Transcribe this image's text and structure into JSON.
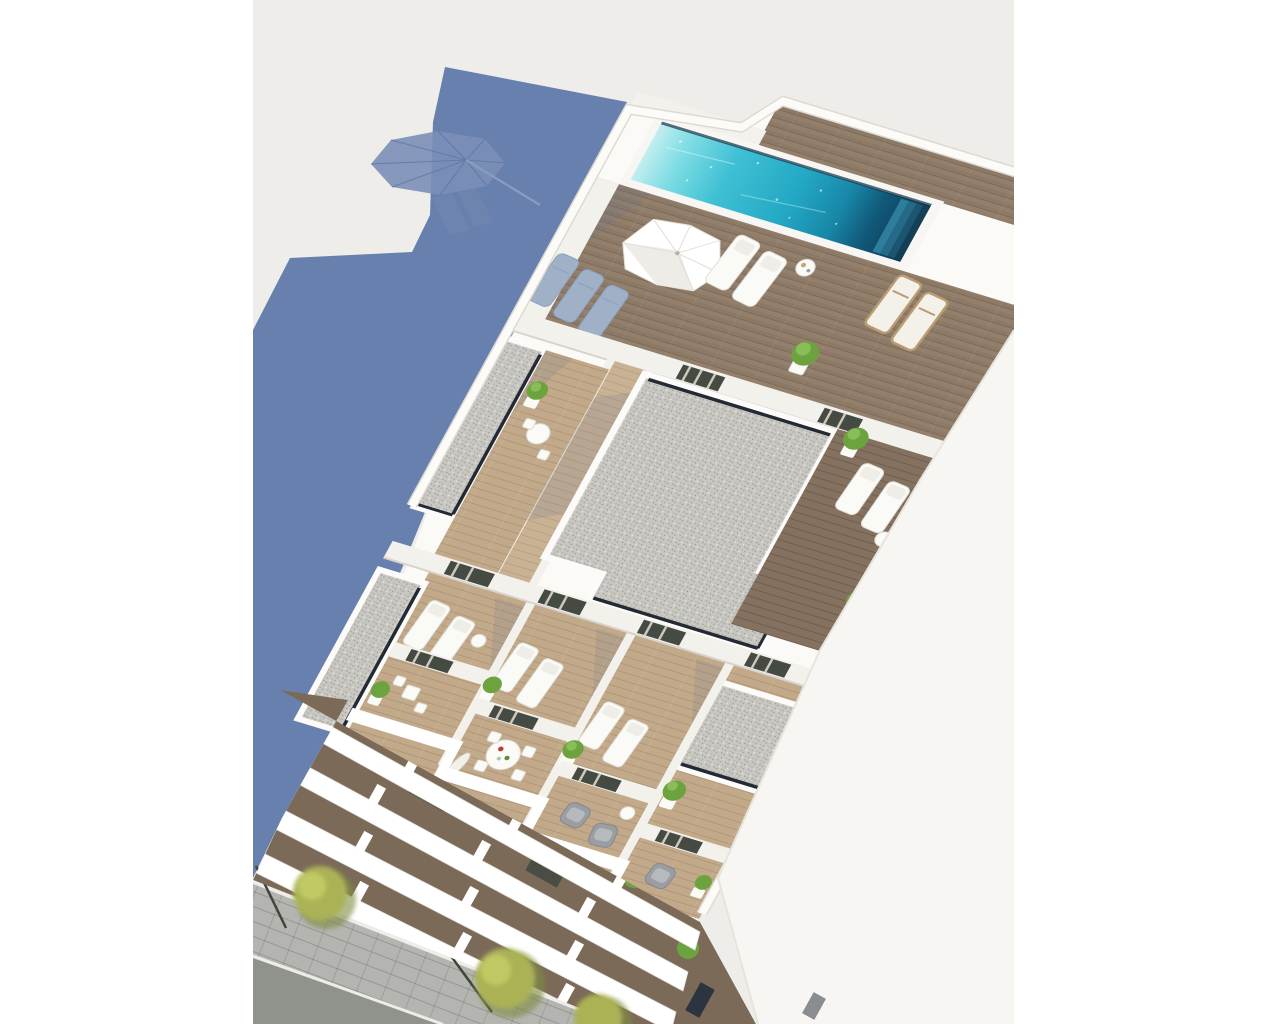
{
  "scene": {
    "type": "architectural-3d-render",
    "subject": "aerial view of an apartment building rooftop with swimming pool, sun terraces, balconies and street",
    "view": "bird's-eye oblique"
  },
  "palette": {
    "margin": "#ffffff",
    "ground": "#eeede9",
    "shadow": "#6880ad",
    "shadow_light": "#7b8eb8",
    "building_white": "#fbfaf7",
    "parapet": "#ffffff",
    "parapet_edge": "#ddd9d3",
    "wall_sun": "#f7f6f2",
    "wall_shade": "#d8d4cd",
    "wall_face": "#f3f1ec",
    "gravel_base": "#c9c7c2",
    "slit": "#232a33",
    "wood_deck": "#93806c",
    "wood_terrace": "#c2a98a",
    "wood_corridor": "#c9b193",
    "wood_dark": "#84715f",
    "pool_edge": "#0d3145",
    "pool_light": "#c2eef0",
    "pool_mid": "#23a8c4",
    "pool_deep": "#11597a",
    "pool_dark": "#0d3a52",
    "step1": "#2e7d9b",
    "step2": "#256a88",
    "step3": "#1c5572",
    "step4": "#143f57",
    "door_glass": "#454b42",
    "curtain": "#cfc9bb",
    "lounger_white": "#fafaf7",
    "lounger_gray": "#9fb0c7",
    "lounger_frame": "#b99c72",
    "armchair": "#9a9ea3",
    "plant": "#6da33e",
    "plant_light": "#8fc45e",
    "pot": "#fafaf7",
    "facade_gap": "#7b6a58",
    "sidewalk": "#b4b5b0",
    "asphalt": "#90928c",
    "curb": "#ecece8",
    "tree": "#aab254",
    "tree_dark": "#7f8c3f",
    "pole": "#3f443c",
    "table_red": "#c23b2e",
    "table_green": "#5d8b38",
    "table_tan": "#c9a86a"
  },
  "objects": [
    {
      "id": "building-shadow",
      "label": "blue shadow cast by building on ground"
    },
    {
      "id": "parasol-shadow",
      "label": "octagonal parasol shadow"
    },
    {
      "id": "rooftop-pool",
      "label": "turquoise rooftop swimming pool with dark deep end steps"
    },
    {
      "id": "pool-parasol",
      "label": "white octagonal parasol on pool deck"
    },
    {
      "id": "sun-loungers",
      "label": "white, gray and wood framed sun loungers"
    },
    {
      "id": "gravel-roofs",
      "label": "gray gravel roof volumes with dark edge gaps"
    },
    {
      "id": "wood-terraces",
      "label": "wooden terraces with plants and tables"
    },
    {
      "id": "dining-set",
      "label": "round white dining table with chairs"
    },
    {
      "id": "armchairs",
      "label": "gray balcony armchairs"
    },
    {
      "id": "balcony-facade",
      "label": "stacked white balcony slabs of the facade"
    },
    {
      "id": "street",
      "label": "sidewalk, asphalt road, trees and lamp posts"
    }
  ]
}
